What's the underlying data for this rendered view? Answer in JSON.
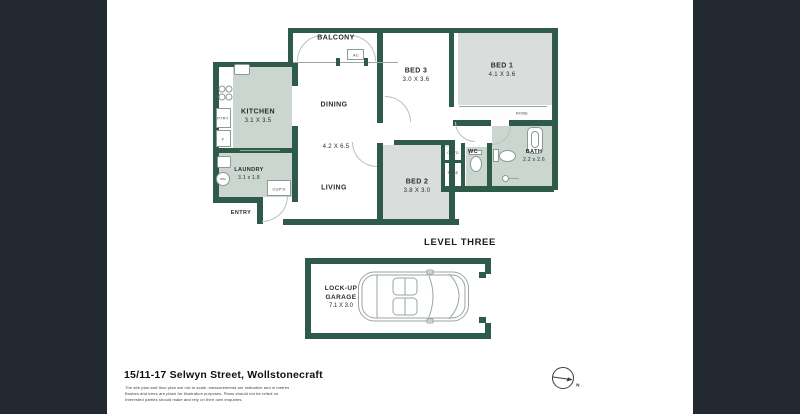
{
  "theme": {
    "background": "#222931",
    "card": "#ffffff",
    "wall_green": "#2d5a49",
    "room_sage": "#ccd6d0",
    "room_gray": "#d9dedd"
  },
  "floorplan": {
    "level_label": "LEVEL THREE",
    "rooms": {
      "balcony": {
        "name": "BALCONY"
      },
      "dining": {
        "name": "DINING"
      },
      "living": {
        "name": "LIVING",
        "dims": "4.2 X 6.5"
      },
      "kitchen": {
        "name": "KITCHEN",
        "dims": "3.1 X 3.5"
      },
      "laundry": {
        "name": "LAUNDRY",
        "dims": "3.1 x 1.8"
      },
      "entry": {
        "name": "ENTRY"
      },
      "bed1": {
        "name": "BED 1",
        "dims": "4.1 X 3.6"
      },
      "bed2": {
        "name": "BED 2",
        "dims": "3.8 X 3.0"
      },
      "bed3": {
        "name": "BED 3",
        "dims": "3.0 X 3.6"
      },
      "bath": {
        "name": "BATH",
        "dims": "2.2 x 2.6"
      },
      "wc": {
        "name": "WC"
      },
      "garage": {
        "line1": "LOCK-UP",
        "line2": "GARAGE",
        "dims": "7.1 X 3.0"
      }
    },
    "fixtures": {
      "ac": "AC",
      "pantry": "PTRY",
      "fridge": "F",
      "cupboard": "CUP'D",
      "robe": "ROBE",
      "washer": "WM"
    }
  },
  "footer": {
    "address": "15/11-17 Selwyn Street, Wollstonecraft",
    "disclaimers": [
      "The site plan and floor plan are not to scale, measurements are indicative and in metres",
      "Bushes and trees are place for illustration purposes. Plans should not be relied on.",
      "Interested parties should make and rely on their own enquiries."
    ],
    "compass_n": "N"
  }
}
